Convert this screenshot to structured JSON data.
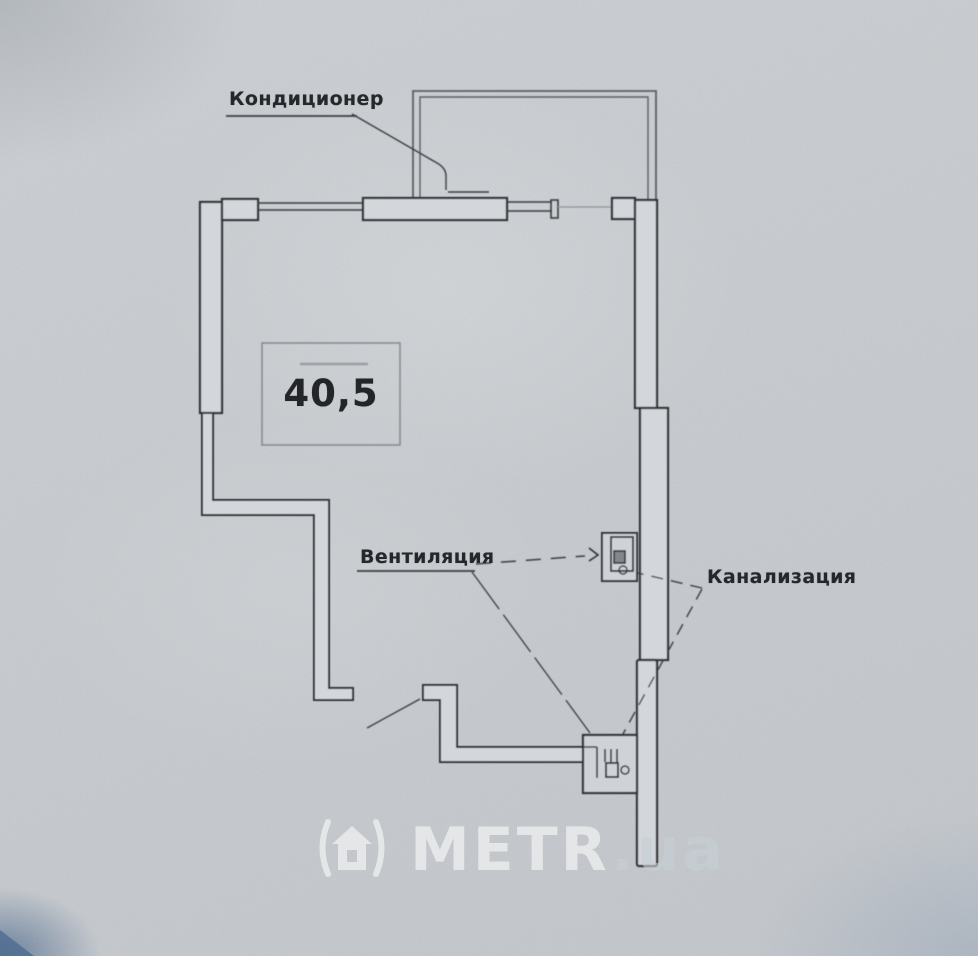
{
  "document": {
    "type": "apartment floor plan (scanned photo)"
  },
  "labels": {
    "air_conditioner": "Кондиционер",
    "ventilation": "Вентиляция",
    "sewerage": "Канализация"
  },
  "area": {
    "value": "40,5"
  },
  "watermark": {
    "brand": "METR",
    "suffix": ".ua",
    "logo": "metr-house-logo-icon"
  },
  "colors": {
    "paper": "#c7cbcf",
    "ink": "#33363a",
    "wall_fill": "#d3d6da",
    "corner_shadow": "#50698c",
    "watermark": "#ffffff"
  }
}
